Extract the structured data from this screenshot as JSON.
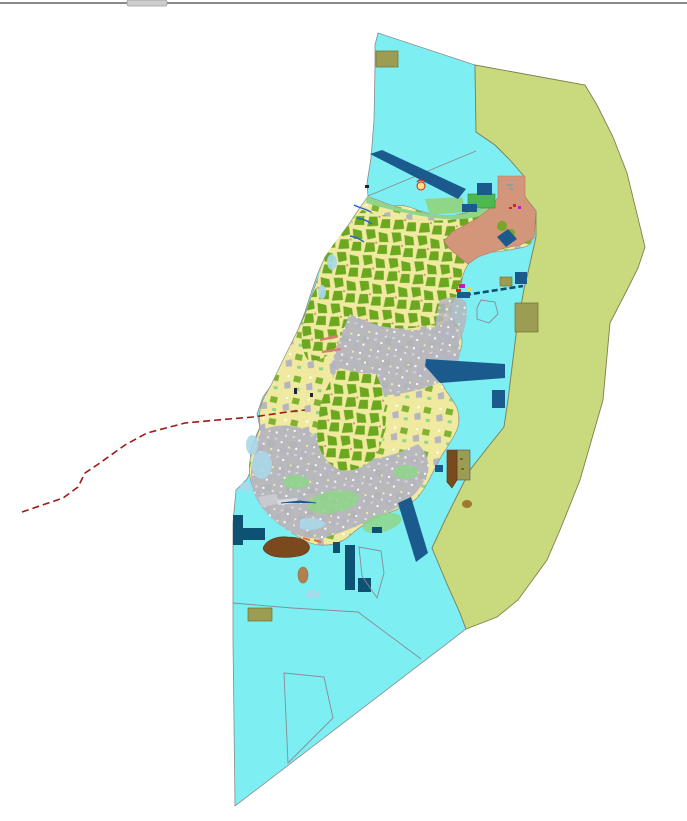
{
  "window": {
    "top_bar": {
      "name": "window-edge-bar",
      "color": "#8a8a8a",
      "tab_color": "#cdcdcd",
      "tab_border": "#9a9a9a"
    }
  },
  "map": {
    "background": "#ffffff",
    "regions": [
      {
        "id": "water",
        "name": "Coastal water zone",
        "color": "#7deef2",
        "border": "#8a8a8a"
      },
      {
        "id": "east-zone",
        "name": "Eastern offshore zone",
        "color": "#c9da7e",
        "border": "#7f7f4f"
      },
      {
        "id": "island",
        "name": "Island land base parcels",
        "color": "#f0eaa0",
        "border": "#90908a"
      },
      {
        "id": "forest",
        "name": "Forest and farm parcels",
        "color": "#6ba81f"
      },
      {
        "id": "urban",
        "name": "Urban built-up parcels",
        "color": "#b5b5bf"
      },
      {
        "id": "coastal-green",
        "name": "North coastal green strip",
        "color": "#8fd689"
      },
      {
        "id": "northeast-district",
        "name": "Northeast salmon district",
        "color": "#d4967a",
        "border": "#b07a5e"
      },
      {
        "id": "port",
        "name": "Port and breakwater structures",
        "color": "#1b5a8c"
      },
      {
        "id": "port-dark",
        "name": "Dark quay structures",
        "color": "#0d5273"
      },
      {
        "id": "reserved",
        "name": "Khaki reserved parcels",
        "color": "#9c9c52",
        "border": "#6f6f30"
      },
      {
        "id": "brown-district",
        "name": "Brown shore district",
        "color": "#7a4a1e",
        "border": "#5a3210"
      },
      {
        "id": "green-block",
        "name": "Green facility block",
        "color": "#4db84d",
        "border": "#2f8f2f"
      },
      {
        "id": "pale-shallow",
        "name": "Pale shallow tidal flats",
        "color": "#aad9ea"
      },
      {
        "id": "tan-islet",
        "name": "Tan islet",
        "color": "#b08050",
        "border": "#907040"
      }
    ],
    "lines": [
      {
        "id": "red-boundary",
        "name": "Dashed administrative boundary",
        "color": "#a01818",
        "style": "dashed"
      },
      {
        "id": "teal-channel",
        "name": "Dashed channel / cable line",
        "color": "#0d4f73",
        "style": "dashed"
      },
      {
        "id": "divider",
        "name": "Thin zone divider line",
        "color": "#8a8a8a",
        "style": "solid"
      },
      {
        "id": "stream",
        "name": "Coastal streams",
        "color": "#2263cc",
        "style": "solid"
      },
      {
        "id": "pier",
        "name": "Pink piers",
        "color": "#e07878",
        "style": "solid"
      },
      {
        "id": "orange-shore",
        "name": "Orange shoreline works",
        "color": "#e07030",
        "style": "solid"
      }
    ],
    "markers": [
      {
        "id": "beacon",
        "name": "Round beacon marker",
        "fill": "#ffe080",
        "ring": "#cc2020"
      },
      {
        "id": "harbor-symbols",
        "name": "Harbor point symbols",
        "colors": [
          "#c318c3",
          "#dd2222",
          "#ffd040"
        ]
      }
    ]
  }
}
